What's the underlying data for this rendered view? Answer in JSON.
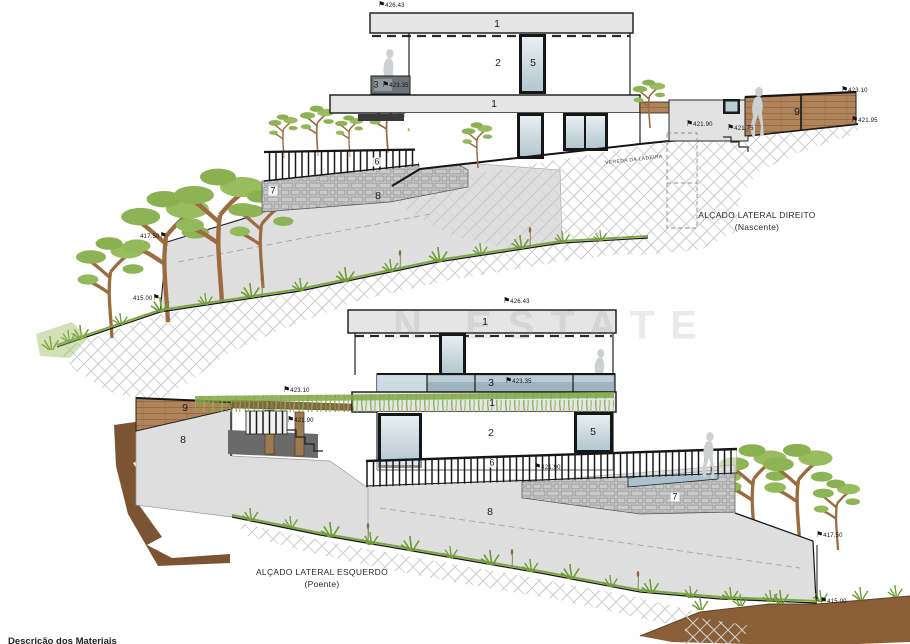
{
  "watermark": "N ESTATE",
  "footer": {
    "materials_title": "Descrição dos Materiais"
  },
  "top": {
    "title": "ALÇADO LATERAL DIREITO",
    "subtitle": "(Nascente)",
    "street_name": "VEREDA DA LADEIRA",
    "labels": {
      "roof_slab": "1",
      "mid_slab": "1",
      "upper_wall": "2",
      "parapet": "3",
      "window": "5",
      "railing": "6",
      "stone_wall": "7",
      "slope_wall": "8",
      "wood_fence": "9"
    },
    "markers": {
      "roof": "426.43",
      "parapet": "423.35",
      "fence_top": "423.10",
      "street_upper": "421.90",
      "street_mid": "421.75",
      "street_lower": "421.95",
      "wall_top": "417.50",
      "wall_base": "415.00"
    }
  },
  "bottom": {
    "title": "ALÇADO LATERAL ESQUERDO",
    "subtitle": "(Poente)",
    "labels": {
      "roof_slab": "1",
      "mid_slab": "1",
      "glass_band": "3",
      "lower_wall": "2",
      "window": "5",
      "railing": "6",
      "stone_wall": "7",
      "slope_wall": "8",
      "left_wall": "8",
      "wood_fence": "9"
    },
    "markers": {
      "roof": "426.43",
      "glass_band": "423.35",
      "pergola_top": "423.10",
      "stairs": "421.90",
      "terrace": "421.90",
      "wall_top": "417.50",
      "wall_base": "415.00"
    }
  }
}
